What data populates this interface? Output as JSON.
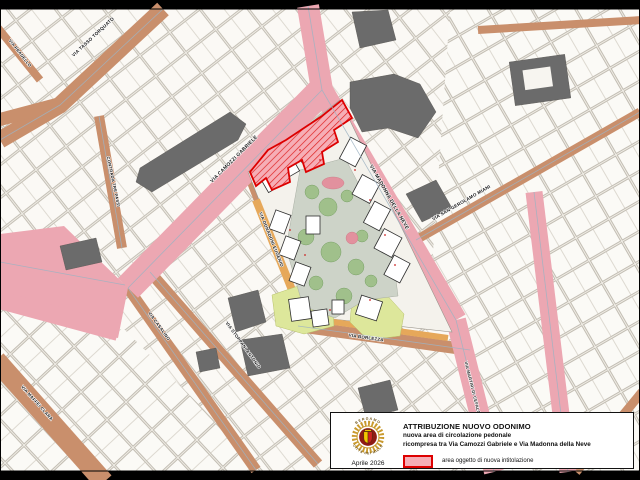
{
  "legend": {
    "title": "ATTRIBUZIONE NUOVO ODONIMO",
    "line1": "nuova area di circolazione pedonale",
    "line2": "ricompresa tra Via Camozzi Gabriele e Via Madonna della Neve",
    "item_label": "area oggetto di nuova intitolazione",
    "date": "Aprile 2026",
    "logo_top": "BERGAMO",
    "logo_bottom": "CITTÀ DEI MILLE"
  },
  "streets": [
    {
      "name": "VIA PRADELLO"
    },
    {
      "name": "VIA TASSO TORQUATO"
    },
    {
      "name": "CONTRADA TRE PASSI"
    },
    {
      "name": "VIA CAMOZZI GABRIELE"
    },
    {
      "name": "VIA MADONNA DELLA NEVE"
    },
    {
      "name": "VIA SAN GEROLAMO MIANI"
    },
    {
      "name": "VIA DONADONI EUGENIO"
    },
    {
      "name": "VIA CASALINO"
    },
    {
      "name": "VIA STOPPANI ANTONIO"
    },
    {
      "name": "VIA BORLEZZA"
    },
    {
      "name": "VIA MAFFEI CLARA"
    },
    {
      "name": "VIA MARTIRI DI CEFALONIA"
    }
  ],
  "colors": {
    "street_tan": "#c98f6c",
    "street_pink": "#eca7b2",
    "new_area_fill": "#f6aeb6",
    "new_area_border": "#dd0000",
    "courtyard": "#cdd3c8",
    "tree_green": "#9cbf85",
    "lime_area": "#dde79b",
    "orange_strip": "#e6a85a",
    "dark_building": "#6b6b6b",
    "map_background": "#f1eee8"
  }
}
